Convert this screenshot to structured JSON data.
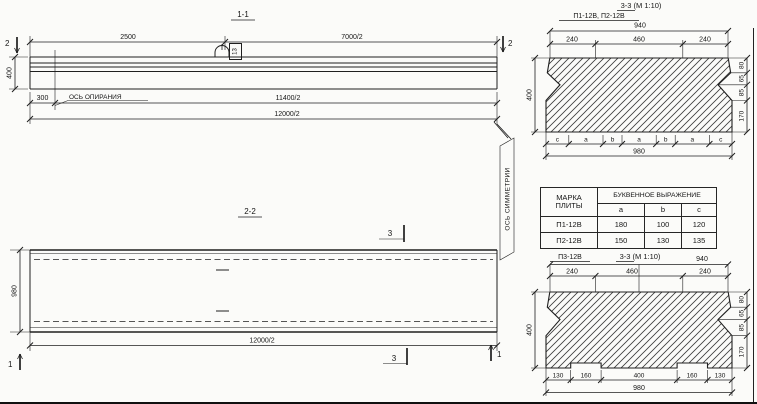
{
  "section11": {
    "title": "1-1",
    "dim_top_left": "2500",
    "dim_top_right": "7000/2",
    "dim_height": "400",
    "dim_offset": "300",
    "dim_mid": "11400/2",
    "dim_total": "12000/2",
    "support_axis": "ОСЬ ОПИРАНИЯ",
    "hook_label": "13",
    "marker_left": "2",
    "marker_right": "2"
  },
  "section22": {
    "title": "2-2",
    "dim_width": "980",
    "dim_total": "12000/2",
    "marker_top": "3",
    "marker_bottom": "3",
    "marker_left": "1",
    "marker_right": "1",
    "symmetry_axis": "ОСЬ СИММЕТРИИ"
  },
  "cs_top": {
    "label": "П1-12В, П2-12В",
    "title": "3-3 (М 1:10)",
    "dim_940": "940",
    "dim_240l": "240",
    "dim_460": "460",
    "dim_240r": "240",
    "dim_400": "400",
    "right_dims": [
      "80",
      "65",
      "85",
      "170"
    ],
    "letters": [
      "c",
      "a",
      "b",
      "a",
      "b",
      "a",
      "c"
    ],
    "dim_980": "980"
  },
  "table": {
    "header_mark1": "МАРКА",
    "header_mark2": "ПЛИТЫ",
    "header_expr": "БУКВЕННОЕ ВЫРАЖЕНИЕ",
    "col_a": "a",
    "col_b": "b",
    "col_c": "c",
    "rows": [
      {
        "mark": "П1-12В",
        "a": "180",
        "b": "100",
        "c": "120"
      },
      {
        "mark": "П2-12В",
        "a": "150",
        "b": "130",
        "c": "135"
      }
    ]
  },
  "cs_bottom": {
    "label": "П3-12В",
    "title": "3-3 (М 1:10)",
    "dim_940": "940",
    "dim_240l": "240",
    "dim_460": "460",
    "dim_240r": "240",
    "dim_400": "400",
    "right_dims": [
      "80",
      "65",
      "85",
      "170"
    ],
    "bottom_dims": [
      "130",
      "160",
      "400",
      "160",
      "130"
    ],
    "dim_980": "980"
  }
}
